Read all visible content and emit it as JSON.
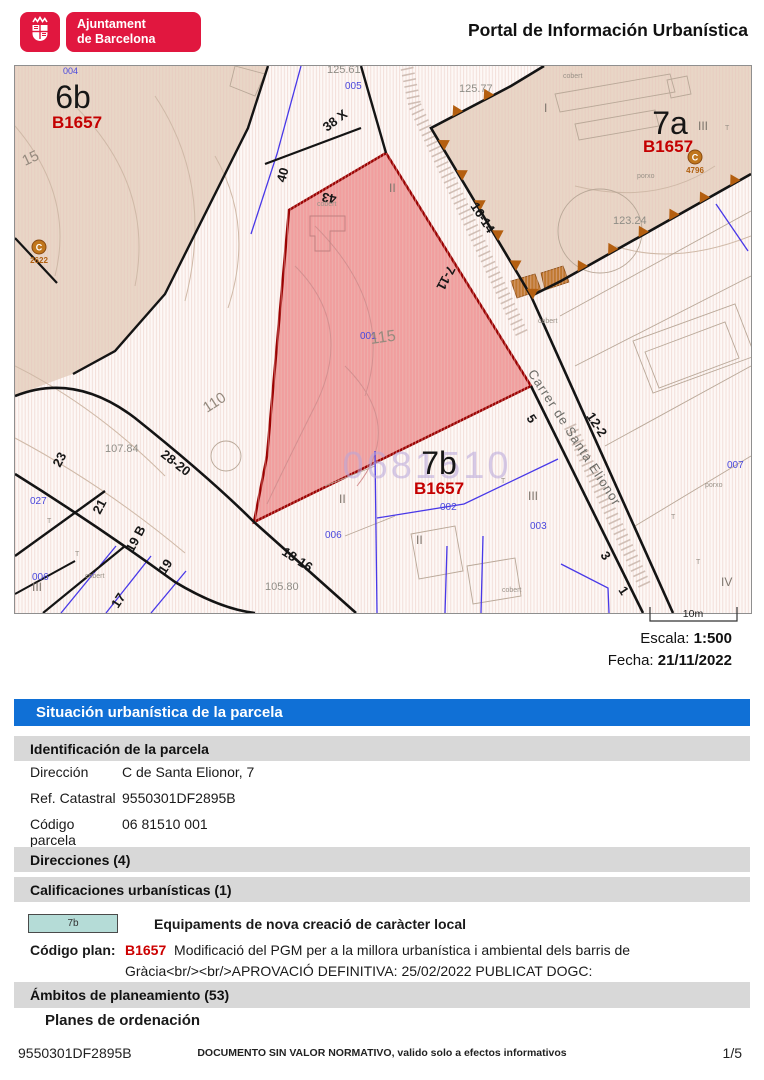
{
  "header": {
    "logo_line1": "Ajuntament",
    "logo_line2": "de Barcelona",
    "title": "Portal de Información Urbanística"
  },
  "map": {
    "scale_bar": "10m",
    "escala_label": "Escala:",
    "escala_value": "1:500",
    "fecha_label": "Fecha:",
    "fecha_value": "21/11/2022",
    "colors": {
      "highlight_parcel_fill": "#f19e9e",
      "highlight_parcel_border": "#9b0000",
      "zone_fill": "#e8d6c6",
      "plan_code_red": "#c40000",
      "parcel_number_blue": "#4a48dd",
      "boundary_marker_orange": "#b45f10"
    },
    "labels": {
      "l_004": "004",
      "l_6b": "6b",
      "l_b6": "B1657",
      "l_15": "15",
      "l_c1": "C",
      "l_c1n": "2622",
      "l_110": "110",
      "l_10784": "107.84",
      "l_2820": "28-20",
      "l_23": "23",
      "l_21": "21",
      "l_19b": "19 B",
      "l_19": "19",
      "l_17": "17",
      "l_027": "027",
      "l_006a": "006",
      "l_iii_a": "III",
      "l_cob_a": "cobert",
      "l_10580": "105.80",
      "l_1816": "18-16",
      "l_12561": "125.61",
      "l_005": "005",
      "l_38x": "38 X",
      "l_40": "40",
      "l_43": "43",
      "l_cob_b": "cobert",
      "l_12577": "125.77",
      "l_1614": "16-14",
      "l_711": "7-11",
      "l_i": "I",
      "l_cob_c": "cobert",
      "l_7a": "7a",
      "l_iii_b": "III",
      "l_b7a": "B1657",
      "l_c2": "C",
      "l_c2n": "4796",
      "l_porxo_a": "porxo",
      "l_t1": "T",
      "l_12324": "123.24",
      "l_carrer": "Carrer de Santa Elionor",
      "l_122": "12-2",
      "l_5": "5",
      "l_001": "001",
      "l_115": "115",
      "l_wm": "0681510",
      "l_7b": "7b",
      "l_b7b": "B1657",
      "l_002": "002",
      "l_iii_c": "III",
      "l_003": "003",
      "l_ii_a": "II",
      "l_ii_b": "II",
      "l_ii_c": "II",
      "l_006b": "006",
      "l_cob_d": "cobert",
      "l_iv": "IV",
      "l_3": "3",
      "l_1": "1",
      "l_007": "007",
      "l_porxo_b": "porxo",
      "l_t2": "T",
      "l_t3": "T",
      "l_t4": "T",
      "l_t5": "T",
      "l_t6": "T",
      "l_cob_e": "cobert"
    }
  },
  "sections": {
    "situacion_title": "Situación urbanística de la parcela",
    "identificacion_title": "Identificación de la parcela",
    "fields": [
      {
        "label": "Dirección",
        "value": "C de Santa Elionor, 7"
      },
      {
        "label": "Ref. Catastral",
        "value": "9550301DF2895B"
      },
      {
        "label": "Código parcela",
        "value": "06 81510 001"
      }
    ],
    "direcciones_title": "Direcciones (4)",
    "calificaciones_title": "Calificaciones urbanísticas (1)",
    "calificacion": {
      "swatch_code": "7b",
      "label": "Equipaments de nova creació de caràcter local"
    },
    "codigo_plan": {
      "label": "Código plan:",
      "code": "B1657",
      "text": "Modificació del PGM per a la millora urbanística i ambiental dels barris de Gràcia<br/><br/>APROVACIÓ DEFINITIVA: 25/02/2022 PUBLICAT DOGC: 04/03/2022"
    },
    "ambitos_title": "Ámbitos de planeamiento (53)",
    "planes_subtitle": "Planes de ordenación"
  },
  "footer": {
    "ref": "9550301DF2895B",
    "notice": "DOCUMENTO SIN VALOR NORMATIVO, valido solo a efectos informativos",
    "page": "1/5"
  }
}
